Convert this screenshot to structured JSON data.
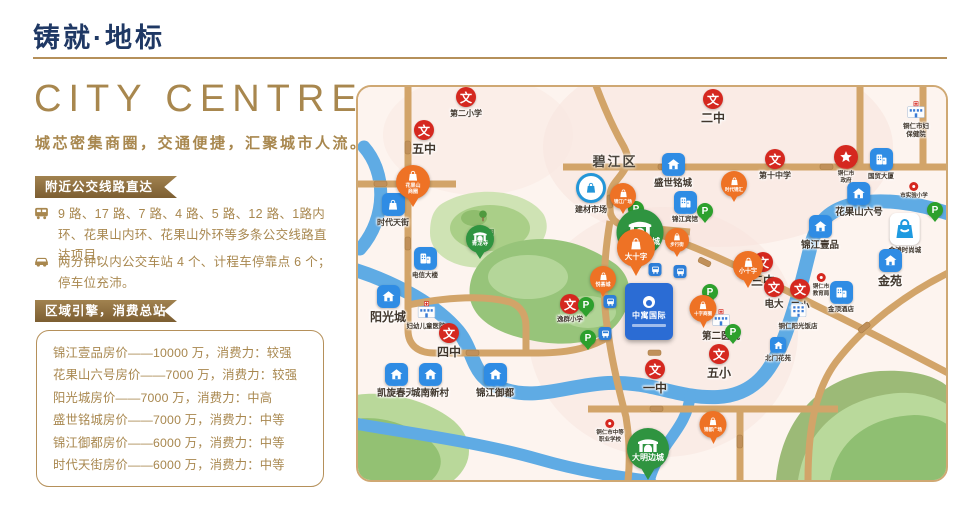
{
  "page": {
    "title": "铸就·地标",
    "hero_title": "CITY CENTRE",
    "hero_subtitle": "城芯密集商圈，交通便捷，汇聚城市人流。"
  },
  "transport": {
    "ribbon": "附近公交线路直达",
    "items": [
      {
        "icon": "bus-icon",
        "text": "9 路、17 路、7 路、4 路、5 路、12 路、1路内环、花果山内环、花果山外环等多条公交线路直达项目。"
      },
      {
        "icon": "car-icon",
        "text": "两分钟以内公交车站 4 个、计程车停靠点 6 个；停车位充沛。"
      }
    ]
  },
  "consumption": {
    "ribbon": "区域引擎，消费总站",
    "items": [
      "锦江壹品房价——10000 万，消费力：较强",
      "花果山六号房价——7000 万，消费力：较强",
      "阳光城房价——7000 万，消费力：中高",
      "盛世铭城房价——7000 万，消费力：中等",
      "锦江御都房价——6000 万，消费力：中等",
      "时代天街房价——6000 万，消费力：中等"
    ]
  },
  "map": {
    "district_label": "碧江区",
    "park_label": "三江公园",
    "project": {
      "name": "中寓国际"
    },
    "colors": {
      "red": "#d5281f",
      "orange": "#ee7225",
      "green_pin": "#2f9440",
      "blue": "#2f8ce4",
      "parking": "#2da02d",
      "road": "#d2a469",
      "river": "#5fabe4"
    },
    "markers": [
      {
        "t": "shop",
        "x": 55,
        "y": 78,
        "d": 34,
        "fs": 5,
        "lines": [
          "花果山",
          "商圈"
        ]
      },
      {
        "t": "school",
        "x": 108,
        "y": 0,
        "ls": "s",
        "label": "第二小学"
      },
      {
        "t": "school",
        "x": 66,
        "y": 33,
        "ls": "b",
        "label": "五中"
      },
      {
        "t": "school",
        "x": 355,
        "y": 2,
        "ls": "b",
        "label": "二中"
      },
      {
        "t": "school",
        "x": 417,
        "y": 62,
        "ls": "s",
        "label": "第十中学"
      },
      {
        "t": "school",
        "x": 405,
        "y": 165,
        "ls": "b",
        "label": "三中"
      },
      {
        "t": "school",
        "x": 416,
        "y": 190,
        "ls": "m",
        "label": "电大"
      },
      {
        "t": "school",
        "x": 442,
        "y": 192,
        "ls": "m",
        "label": "二小"
      },
      {
        "t": "school",
        "x": 91,
        "y": 236,
        "ls": "b",
        "label": "四中"
      },
      {
        "t": "school",
        "x": 297,
        "y": 272,
        "ls": "b",
        "label": "一中"
      },
      {
        "t": "school",
        "x": 361,
        "y": 257,
        "ls": "b",
        "label": "五小"
      },
      {
        "t": "school",
        "x": 212,
        "y": 207,
        "ls": "xs",
        "label": "逸群小学"
      },
      {
        "t": "gov",
        "x": 488,
        "y": 58,
        "label": "铜仁市\n政府"
      },
      {
        "t": "poi",
        "x": 463,
        "y": 186,
        "label": "铜仁市\n教育局"
      },
      {
        "t": "poi",
        "x": 556,
        "y": 95,
        "label": "市实验小学"
      },
      {
        "t": "poi",
        "x": 252,
        "y": 332,
        "label": "铜仁市中等\n职业学校"
      },
      {
        "t": "hospital",
        "x": 558,
        "y": 12,
        "ls": "xs",
        "label": "铜仁市妇\n保健院"
      },
      {
        "t": "hospital",
        "x": 363,
        "y": 220,
        "ls": "m",
        "label": "第二医院"
      },
      {
        "t": "hospital",
        "x": 68,
        "y": 212,
        "ls": "xs",
        "label": "妇幼儿童医院"
      },
      {
        "t": "res",
        "x": 315,
        "y": 66,
        "ls": "m",
        "label": "盛世铭城"
      },
      {
        "t": "res",
        "x": 501,
        "y": 95,
        "ls": "m",
        "label": "花果山六号"
      },
      {
        "t": "res",
        "x": 462,
        "y": 128,
        "ls": "m",
        "label": "锦江壹品"
      },
      {
        "t": "res",
        "x": 532,
        "y": 162,
        "ls": "b",
        "label": "金苑"
      },
      {
        "t": "res",
        "x": 30,
        "y": 198,
        "ls": "b",
        "label": "阳光城"
      },
      {
        "t": "res",
        "x": 38,
        "y": 276,
        "ls": "m",
        "label": "凯旋春天"
      },
      {
        "t": "res",
        "x": 72,
        "y": 276,
        "ls": "m",
        "label": "城南新村"
      },
      {
        "t": "res",
        "x": 137,
        "y": 276,
        "ls": "m",
        "label": "锦江御都"
      },
      {
        "t": "res",
        "x": 420,
        "y": 250,
        "ls": "xs",
        "sm": true,
        "label": "北门花苑"
      },
      {
        "t": "bagsq",
        "x": 35,
        "y": 106,
        "ls": "s",
        "label": "时代天街"
      },
      {
        "t": "bldg",
        "x": 327,
        "y": 104,
        "ls": "xs",
        "label": "锦江宾馆"
      },
      {
        "t": "bldg",
        "x": 483,
        "y": 194,
        "ls": "xs",
        "label": "金顶酒店"
      },
      {
        "t": "bldgw",
        "x": 440,
        "y": 212,
        "ls": "xs",
        "label": "铜仁阳光饭店"
      },
      {
        "t": "bldg",
        "x": 523,
        "y": 61,
        "ls": "xs",
        "label": "国贸大厦"
      },
      {
        "t": "mallc",
        "x": 233,
        "y": 86,
        "ls": "s",
        "label": "建材市场"
      },
      {
        "t": "bagbig",
        "x": 547,
        "y": 126,
        "ls": "xs",
        "label": "金滩时尚城"
      },
      {
        "t": "bldg",
        "x": 67,
        "y": 160,
        "ls": "xs",
        "label": "电信大楼"
      },
      {
        "t": "shop",
        "x": 265,
        "y": 96,
        "d": 26,
        "fs": 4.5,
        "lines": [
          "锦江广场"
        ]
      },
      {
        "t": "shop",
        "x": 376,
        "y": 84,
        "d": 26,
        "fs": 4.5,
        "lines": [
          "时代锦汇"
        ]
      },
      {
        "t": "shop",
        "x": 278,
        "y": 142,
        "d": 38,
        "fs": 7.5,
        "lines": [
          "大十字"
        ]
      },
      {
        "t": "shop",
        "x": 245,
        "y": 179,
        "d": 26,
        "fs": 5,
        "lines": [
          "悦荟城"
        ]
      },
      {
        "t": "shop",
        "x": 319,
        "y": 141,
        "d": 24,
        "fs": 4.5,
        "lines": [
          "步行街"
        ]
      },
      {
        "t": "shop",
        "x": 390,
        "y": 164,
        "d": 30,
        "fs": 6,
        "lines": [
          "小十字"
        ]
      },
      {
        "t": "shop",
        "x": 345,
        "y": 208,
        "d": 27,
        "fs": 4.5,
        "lines": [
          "十字商圈"
        ]
      },
      {
        "t": "shop",
        "x": 355,
        "y": 324,
        "d": 27,
        "fs": 4.5,
        "lines": [
          "锦都广场"
        ]
      },
      {
        "t": "her",
        "x": 282,
        "y": 122,
        "d": 47,
        "fs": 8,
        "lines": [
          "中南门古城"
        ]
      },
      {
        "t": "her",
        "x": 290,
        "y": 341,
        "d": 42,
        "fs": 8,
        "lines": [
          "大明边城"
        ]
      },
      {
        "t": "her",
        "x": 122,
        "y": 138,
        "d": 28,
        "fs": 5.5,
        "lines": [
          "青龙寺"
        ]
      },
      {
        "t": "park",
        "x": 278,
        "y": 114
      },
      {
        "t": "park",
        "x": 347,
        "y": 116
      },
      {
        "t": "park",
        "x": 228,
        "y": 210
      },
      {
        "t": "park",
        "x": 230,
        "y": 243
      },
      {
        "t": "park",
        "x": 352,
        "y": 197
      },
      {
        "t": "park",
        "x": 375,
        "y": 237
      },
      {
        "t": "park",
        "x": 577,
        "y": 115
      },
      {
        "t": "bus",
        "x": 297,
        "y": 176
      },
      {
        "t": "bus",
        "x": 322,
        "y": 178
      },
      {
        "t": "bus",
        "x": 252,
        "y": 208
      },
      {
        "t": "bus",
        "x": 247,
        "y": 240
      },
      {
        "t": "tree",
        "x": 125,
        "y": 122,
        "label": "三江公园"
      },
      {
        "t": "dist",
        "x": 257,
        "y": 64,
        "label": "碧江区"
      }
    ]
  }
}
